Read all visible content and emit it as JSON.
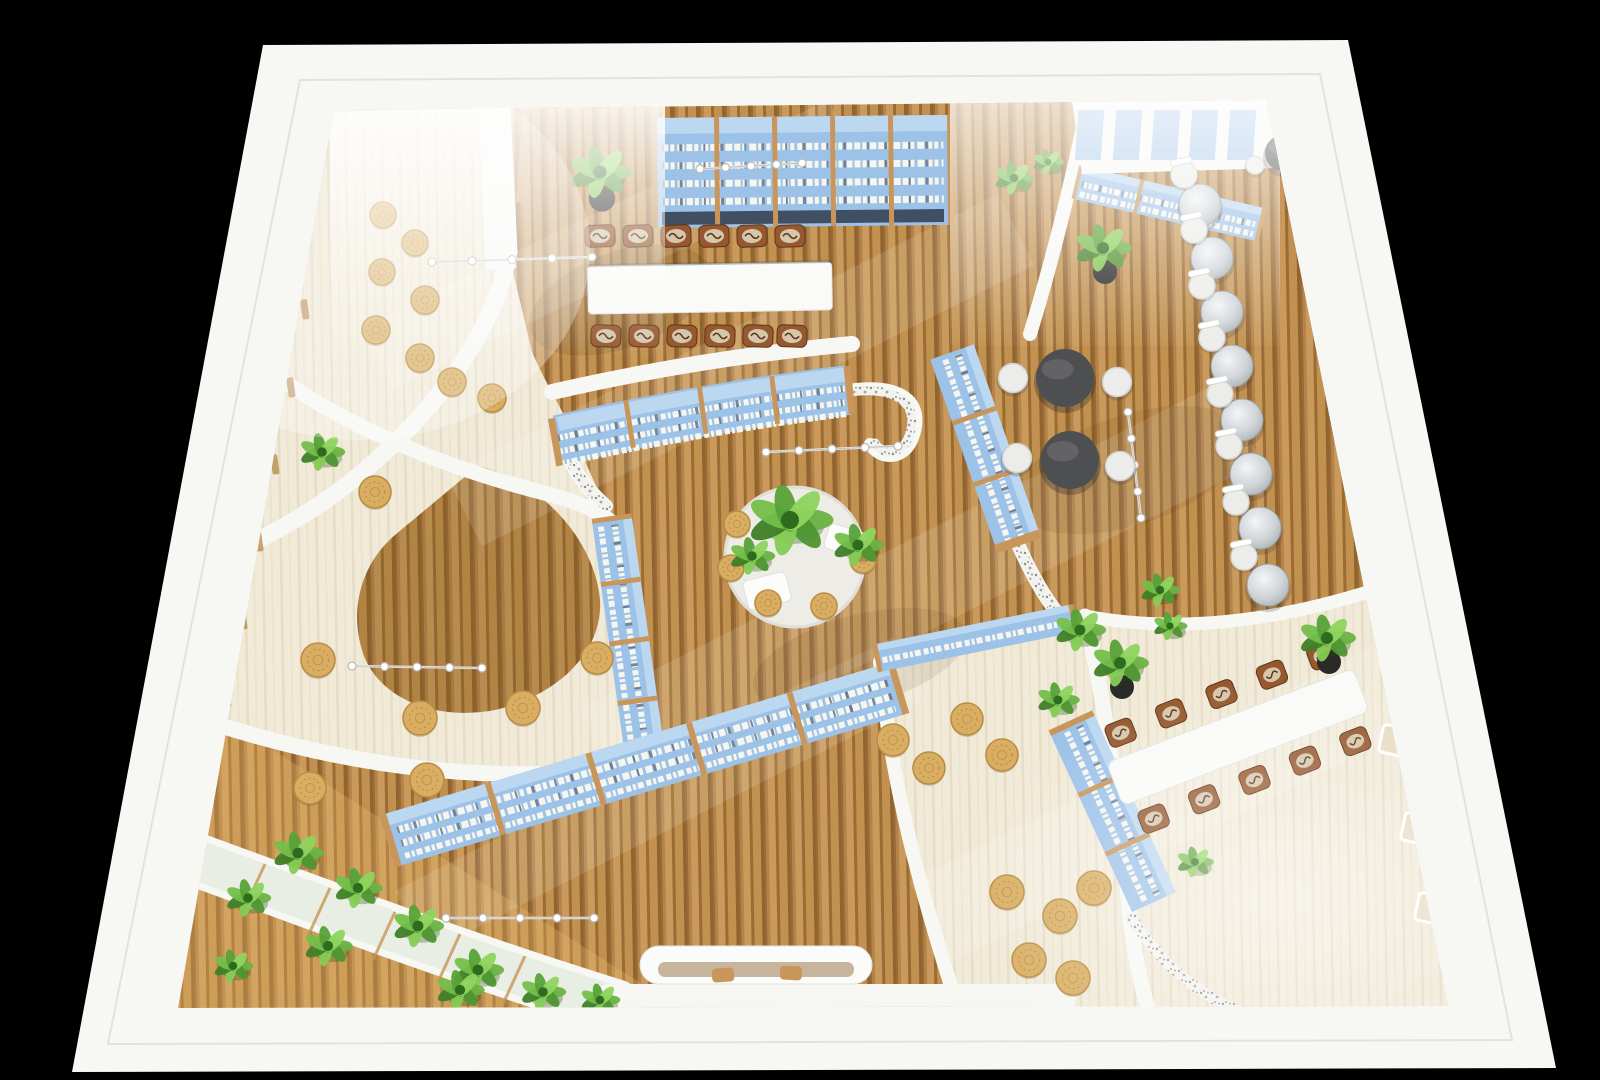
{
  "scene": {
    "title": "Aerial 3D rendering of a library reading-room interior on black background",
    "type": "architectural interior render, top-down perspective",
    "areas": [
      {
        "name": "reading-room-top",
        "features": [
          "wall-bookshelf",
          "long-white-table",
          "12-brown-chairs",
          "potted-plant"
        ]
      },
      {
        "name": "lounge-left",
        "features": [
          "cream-carpet",
          "rattan-floor-cushions",
          "curved-white-walls",
          "teardrop-wood-inlay"
        ]
      },
      {
        "name": "cafe-zone-right",
        "features": [
          "dark-round-tables",
          "white-stools",
          "glass-tables-row",
          "white-chairs"
        ]
      },
      {
        "name": "center-plaza",
        "features": [
          "round-planter-island",
          "floor-cushions",
          "curved-bookshelf",
          "track-lights"
        ]
      },
      {
        "name": "study-zone-bottom-right",
        "features": [
          "long-white-table",
          "10-brown-chairs",
          "bookshelf",
          "potted-plants"
        ]
      },
      {
        "name": "garden-edge-bottom-left",
        "features": [
          "planter-trellis",
          "tropical-plants",
          "long-bookshelf"
        ]
      }
    ]
  },
  "palette": {
    "bg": "#000000",
    "wall": "#f7f7f4",
    "wall_shade": "#e7e7e4",
    "wood_a": "#c99a5b",
    "wood_b": "#b5834a",
    "wood_c": "#9a6b33",
    "wood_d": "#c2914f",
    "wood_e": "#8f6430",
    "cream": "#f1ead8",
    "cream_line": "#e7ddc6",
    "shelf_blue": "#9dc2e8",
    "shelf_blue_light": "#bcd7f0",
    "shelf_blue_dark": "#7fa9d8",
    "shelf_wood": "#c8965a",
    "book_white": "#f6f5ee",
    "book_dark": "#5a6a80",
    "book_band_dark": "#33404f",
    "plant_greens": [
      "#6ab344",
      "#4e9630",
      "#85cc55",
      "#3f7f27",
      "#74bf4a",
      "#57a238",
      "#8ed45e"
    ],
    "plant_core": "#2f6b1f",
    "pot_black": "#2a2a28",
    "cushion_tan": "#d9ae62",
    "cushion_edge": "#b98e44",
    "table_white": "#fafaf8",
    "table_dark": "#4e4f51",
    "chair_brown": "#96582e",
    "chair_pattern": "#d8cdb4",
    "chair_dark": "#5e3518",
    "stool_white": "#ececea",
    "glass_gray": "#c9ced2",
    "speckle_gray": "#8d8d8b",
    "light_track": "#e8e8e6"
  },
  "decor": {
    "cushions": [
      [
        383,
        215,
        13
      ],
      [
        415,
        243,
        13
      ],
      [
        382,
        272,
        13
      ],
      [
        425,
        300,
        14
      ],
      [
        376,
        330,
        14
      ],
      [
        420,
        358,
        14
      ],
      [
        452,
        382,
        14
      ],
      [
        492,
        398,
        14
      ],
      [
        375,
        492,
        16
      ],
      [
        318,
        660,
        17
      ],
      [
        420,
        718,
        17
      ],
      [
        523,
        708,
        17
      ],
      [
        597,
        658,
        16
      ],
      [
        427,
        780,
        17
      ],
      [
        310,
        788,
        16
      ],
      [
        737,
        524,
        13
      ],
      [
        731,
        568,
        13
      ],
      [
        768,
        603,
        13
      ],
      [
        824,
        606,
        13
      ],
      [
        863,
        560,
        13
      ],
      [
        893,
        740,
        16
      ],
      [
        967,
        719,
        16
      ],
      [
        1002,
        755,
        16
      ],
      [
        929,
        768,
        16
      ],
      [
        1007,
        892,
        17
      ],
      [
        1060,
        916,
        17
      ],
      [
        1029,
        960,
        17
      ],
      [
        1094,
        888,
        17
      ],
      [
        1073,
        978,
        17
      ]
    ],
    "plants": [
      {
        "x": 600,
        "y": 172,
        "s": 1.1,
        "pot": true
      },
      {
        "x": 1014,
        "y": 178,
        "s": 0.7,
        "pot": false
      },
      {
        "x": 1048,
        "y": 162,
        "s": 0.55,
        "pot": false
      },
      {
        "x": 1103,
        "y": 248,
        "s": 1.0,
        "pot": true
      },
      {
        "x": 322,
        "y": 452,
        "s": 0.8,
        "pot": false
      },
      {
        "x": 1160,
        "y": 590,
        "s": 0.7,
        "pot": false
      },
      {
        "x": 1080,
        "y": 630,
        "s": 0.9,
        "pot": false
      },
      {
        "x": 1120,
        "y": 663,
        "s": 1.0,
        "pot": true
      },
      {
        "x": 1327,
        "y": 638,
        "s": 1.0,
        "pot": true
      },
      {
        "x": 1058,
        "y": 700,
        "s": 0.75,
        "pot": false
      },
      {
        "x": 1170,
        "y": 626,
        "s": 0.6,
        "pot": false
      },
      {
        "x": 1195,
        "y": 862,
        "s": 0.65,
        "pot": false
      },
      {
        "x": 298,
        "y": 853,
        "s": 0.9,
        "pot": false
      },
      {
        "x": 358,
        "y": 888,
        "s": 0.85,
        "pot": false
      },
      {
        "x": 248,
        "y": 898,
        "s": 0.8,
        "pot": false
      },
      {
        "x": 418,
        "y": 926,
        "s": 0.9,
        "pot": false
      },
      {
        "x": 328,
        "y": 946,
        "s": 0.85,
        "pot": false
      },
      {
        "x": 478,
        "y": 970,
        "s": 0.9,
        "pot": false
      },
      {
        "x": 233,
        "y": 966,
        "s": 0.7,
        "pot": false
      },
      {
        "x": 543,
        "y": 992,
        "s": 0.8,
        "pot": false
      },
      {
        "x": 460,
        "y": 990,
        "s": 0.85,
        "pot": false
      },
      {
        "x": 600,
        "y": 1000,
        "s": 0.7,
        "pot": false
      },
      {
        "x": 790,
        "y": 520,
        "s": 1.5,
        "pot": false
      },
      {
        "x": 858,
        "y": 545,
        "s": 0.9,
        "pot": false
      },
      {
        "x": 752,
        "y": 556,
        "s": 0.8,
        "pot": false
      }
    ],
    "glass_tables": [
      {
        "x": 1200,
        "y": 205,
        "c": [
          -16,
          -30
        ]
      },
      {
        "x": 1212,
        "y": 258,
        "c": [
          -18,
          -28
        ]
      },
      {
        "x": 1222,
        "y": 312,
        "c": [
          -20,
          -26
        ]
      },
      {
        "x": 1232,
        "y": 366,
        "c": [
          -20,
          -28
        ]
      },
      {
        "x": 1242,
        "y": 420,
        "c": [
          -22,
          -26
        ]
      },
      {
        "x": 1251,
        "y": 474,
        "c": [
          -22,
          -28
        ]
      },
      {
        "x": 1260,
        "y": 528,
        "c": [
          -24,
          -26
        ]
      },
      {
        "x": 1268,
        "y": 585,
        "c": [
          -24,
          -28
        ]
      }
    ],
    "dark_tables": [
      {
        "x": 1065,
        "y": 378,
        "r": 29,
        "stools": [
          [
            -52,
            0
          ],
          [
            52,
            4
          ]
        ]
      },
      {
        "x": 1070,
        "y": 460,
        "r": 29,
        "stools": [
          [
            -53,
            -2
          ],
          [
            50,
            6
          ]
        ]
      },
      {
        "x": 1283,
        "y": 153,
        "r": 18,
        "stools": [
          [
            -28,
            12
          ],
          [
            26,
            -14
          ]
        ]
      }
    ],
    "track_lights": [
      {
        "x1": 432,
        "y1": 262,
        "x2": 592,
        "y2": 257
      },
      {
        "x1": 700,
        "y1": 169,
        "x2": 802,
        "y2": 163
      },
      {
        "x1": 766,
        "y1": 452,
        "x2": 898,
        "y2": 446
      },
      {
        "x1": 446,
        "y1": 918,
        "x2": 594,
        "y2": 918
      },
      {
        "x1": 1128,
        "y1": 412,
        "x2": 1141,
        "y2": 518
      },
      {
        "x1": 352,
        "y1": 666,
        "x2": 482,
        "y2": 668
      }
    ],
    "reading_table_chairs": {
      "x_top": [
        600,
        638,
        676,
        714,
        752,
        790
      ],
      "y_top": 236,
      "x_bottom": [
        606,
        644,
        682,
        720,
        758,
        792
      ],
      "y_bottom": 336
    },
    "study_table": {
      "cx": 1238,
      "cy": 737,
      "rot": 69,
      "len": 264,
      "w": 46,
      "chair_ys": [
        -108,
        -54,
        0,
        54,
        108
      ],
      "chair_dx": 46
    },
    "wall_slots": {
      "right_wood": [
        [
          1318,
          196
        ],
        [
          1331,
          258
        ],
        [
          1343,
          322
        ],
        [
          1352,
          384
        ],
        [
          1359,
          438
        ],
        [
          1367,
          520
        ],
        [
          1372,
          554
        ]
      ],
      "right_cream": [
        [
          1384,
          724
        ],
        [
          1406,
          812
        ],
        [
          1420,
          892
        ]
      ],
      "left_wood": [
        [
          300,
          300
        ],
        [
          286,
          378
        ],
        [
          270,
          455
        ],
        [
          254,
          532
        ],
        [
          238,
          610
        ],
        [
          222,
          688
        ],
        [
          207,
          764
        ]
      ],
      "top_blue_x": [
        1086,
        1124,
        1162,
        1200,
        1238
      ],
      "top_gray": [
        [
          440,
          66
        ],
        [
          496,
          63
        ],
        [
          552,
          61
        ]
      ]
    }
  }
}
